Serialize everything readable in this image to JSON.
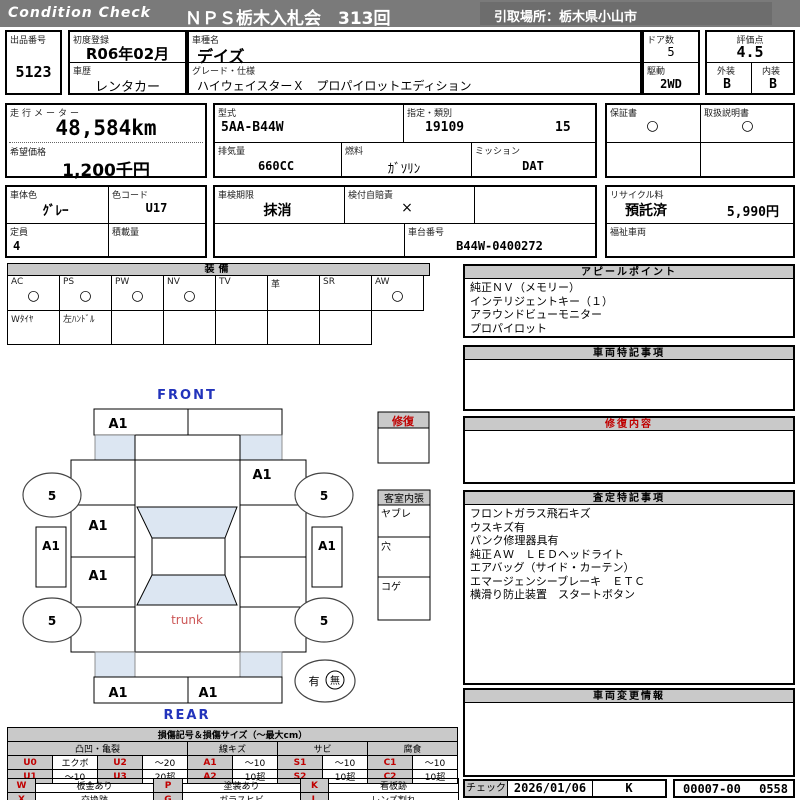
{
  "header": {
    "brand": "Condition  Check",
    "title": "ＮＰＳ栃木入札会　313回",
    "pickup": "引取場所：栃木県小山市"
  },
  "info": {
    "lot_no": {
      "label": "出品番号",
      "value": "5123"
    },
    "first_reg": {
      "label": "初度登録",
      "value": "R06年02月"
    },
    "history": {
      "label": "車歴",
      "value": "レンタカー"
    },
    "model_name": {
      "label": "車種名",
      "value": "デイズ"
    },
    "grade": {
      "label": "グレード・仕様",
      "value": "ハイウェイスターＸ　プロパイロットエディション"
    },
    "doors": {
      "label": "ドア数",
      "value": "5"
    },
    "score": {
      "label": "評価点",
      "value": "4.5"
    },
    "drive": {
      "label": "駆動",
      "value": "2WD"
    },
    "exterior": {
      "label": "外装",
      "value": "B"
    },
    "interior": {
      "label": "内装",
      "value": "B"
    },
    "odometer": {
      "label": "走行メーター",
      "value": "48,584km"
    },
    "asking_price": {
      "label": "希望価格",
      "value": "1,200千円"
    },
    "model_code": {
      "label": "型式",
      "value": "5AA-B44W"
    },
    "class_no": {
      "label": "指定・類別",
      "value1": "19109",
      "value2": "15"
    },
    "displacement": {
      "label": "排気量",
      "value": "660CC"
    },
    "fuel": {
      "label": "燃料",
      "value": "ｶﾞｿﾘﾝ"
    },
    "transmission": {
      "label": "ミッション",
      "value": "DAT"
    },
    "warranty_book": {
      "label": "保証書",
      "mark": "○"
    },
    "manual_book": {
      "label": "取扱説明書",
      "mark": "○"
    },
    "body_color": {
      "label": "車体色",
      "value": "ｸﾞﾚｰ"
    },
    "color_code": {
      "label": "色コード",
      "value": "U17"
    },
    "capacity": {
      "label": "定員",
      "value": "4"
    },
    "load": {
      "label": "積載量",
      "value": ""
    },
    "inspection": {
      "label": "車検期限",
      "value": "抹消"
    },
    "insurance": {
      "label": "検付自賠責",
      "value": "×"
    },
    "chassis_no": {
      "label": "車台番号",
      "value": "B44W-0400272"
    },
    "recycle": {
      "label": "リサイクル料",
      "status": "預託済",
      "fee": "5,990円"
    },
    "welfare": {
      "label": "福祉車両",
      "value": ""
    }
  },
  "equipment": {
    "title": "装備",
    "items": [
      {
        "label": "AC",
        "mark": "○"
      },
      {
        "label": "PS",
        "mark": "○"
      },
      {
        "label": "PW",
        "mark": "○"
      },
      {
        "label": "NV",
        "mark": "○"
      },
      {
        "label": "TV",
        "mark": ""
      },
      {
        "label": "革",
        "mark": ""
      },
      {
        "label": "SR",
        "mark": ""
      },
      {
        "label": "AW",
        "mark": "○"
      }
    ],
    "row2": [
      "Wﾀｲﾔ",
      "左ﾊﾝﾄﾞﾙ",
      "",
      "",
      "",
      "",
      ""
    ]
  },
  "panels": {
    "appeal": {
      "title": "アピールポイント",
      "lines": [
        "純正ＮＶ（メモリー）",
        "インテリジェントキー（１）",
        "アラウンドビューモニター",
        "プロパイロット"
      ]
    },
    "vehicle_notes": {
      "title": "車両特記事項"
    },
    "repair_detail": {
      "title": "修復内容"
    },
    "assessment_notes": {
      "title": "査定特記事項",
      "lines": [
        "フロントガラス飛石キズ",
        "ウスキズ有",
        "パンク修理器具有",
        "純正ＡＷ　ＬＥＤヘッドライト",
        "エアバッグ（サイド・カーテン）",
        "エマージェンシーブレーキ　ＥＴＣ",
        "横滑り防止装置　スタートボタン"
      ]
    },
    "change_info": {
      "title": "車両変更情報"
    }
  },
  "diagram": {
    "front_label": "FRONT",
    "rear_label": "REAR",
    "trunk_label": "trunk",
    "tire_size": "5",
    "marks": {
      "front_bumper": "A1",
      "right_front_fender": "A1",
      "left_front_door": "A1",
      "left_rear_door": "A1",
      "left_sill": "A1",
      "right_sill": "A1",
      "rear_bumper_left": "A1",
      "rear_bumper_right": "A1"
    },
    "presence": {
      "yes": "有",
      "no": "無"
    },
    "repair_box_title": "修復",
    "interior_box": {
      "title": "客室内張",
      "rows": [
        "ヤブレ",
        "穴",
        "コゲ"
      ]
    }
  },
  "legend": {
    "title": "損傷記号＆損傷サイズ（～最大cm）",
    "groups": [
      "凸凹・亀裂",
      "線キズ",
      "サビ",
      "腐食"
    ],
    "row1": [
      {
        "code": "U0",
        "val": "エクボ"
      },
      {
        "code": "U2",
        "val": "～20"
      },
      {
        "code": "A1",
        "val": "～10"
      },
      {
        "code": "S1",
        "val": "～10"
      },
      {
        "code": "C1",
        "val": "～10"
      }
    ],
    "row2": [
      {
        "code": "U1",
        "val": "～10"
      },
      {
        "code": "U3",
        "val": "20超"
      },
      {
        "code": "A2",
        "val": "10超"
      },
      {
        "code": "S2",
        "val": "10超"
      },
      {
        "code": "C2",
        "val": "10超"
      }
    ],
    "block2": [
      [
        {
          "code": "W",
          "val": "板金あり"
        },
        {
          "code": "P",
          "val": "塗装あり"
        },
        {
          "code": "K",
          "val": "看板跡"
        }
      ],
      [
        {
          "code": "X",
          "val": "交換跡"
        },
        {
          "code": "G",
          "val": "ガラスヒビ"
        },
        {
          "code": "L",
          "val": "レンズ割れ"
        }
      ]
    ]
  },
  "footer": {
    "check_label": "チェック",
    "check_date": "2026/01/06",
    "checker": "K",
    "stock_no": "00007-00",
    "seq": "0558"
  },
  "colors": {
    "band_gray": "#7a7a7a",
    "header_cell_gray": "#c9c9c9",
    "glass_blue": "#dce6f2",
    "accent_red": "#c00000",
    "accent_blue": "#2233bb"
  }
}
